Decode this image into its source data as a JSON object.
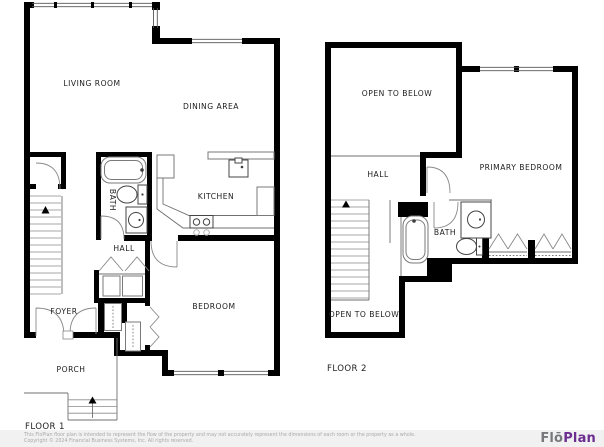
{
  "floors": [
    {
      "label": "FLOOR 1",
      "rooms": {
        "living_room": "LIVING ROOM",
        "dining_area": "DINING AREA",
        "kitchen": "KITCHEN",
        "bath": "BATH",
        "hall": "HALL",
        "bedroom": "BEDROOM",
        "foyer": "FOYER",
        "porch": "PORCH"
      }
    },
    {
      "label": "FLOOR 2",
      "rooms": {
        "open_to_below_top": "OPEN TO BELOW",
        "hall": "HALL",
        "primary_bedroom": "PRIMARY BEDROOM",
        "bath": "BATH",
        "open_to_below_bottom": "OPEN TO BELOW"
      }
    }
  ],
  "footer": {
    "disclaimer": "This FloPlan floor plan is intended to represent the flow of the property and may not accurately represent the dimensions of each room or the property as a whole.",
    "copyright": "Copyright © 2024 Financial Business Systems, Inc. All rights reserved.",
    "logo": {
      "flo": "Flō",
      "plan": "Plan",
      "flo_color": "#77787b",
      "plan_color": "#6b2d90"
    }
  },
  "colors": {
    "wall": "#000000",
    "fixture_line": "#7a7a7a",
    "label": "#1c1c1c",
    "footer_bg": "#f1f1f2",
    "footer_text": "#a9a9a9"
  }
}
